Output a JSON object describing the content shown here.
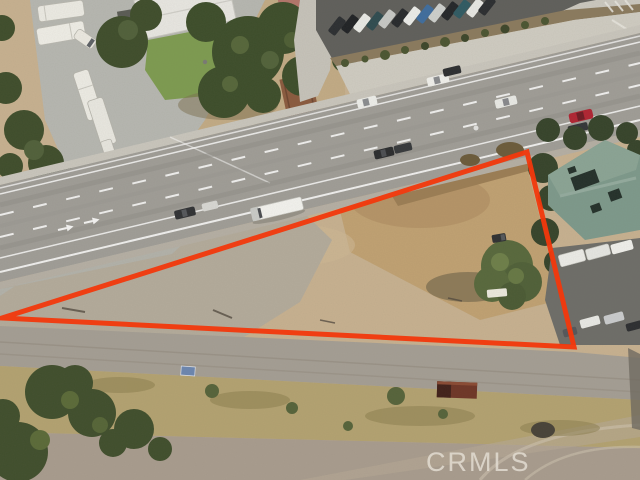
{
  "watermark": {
    "text": "CRMLS",
    "color": "#e2dcd1"
  },
  "boundary": {
    "color": "#f2380c",
    "stroke_width": "5",
    "points": "527,152 2,318 574,347"
  }
}
